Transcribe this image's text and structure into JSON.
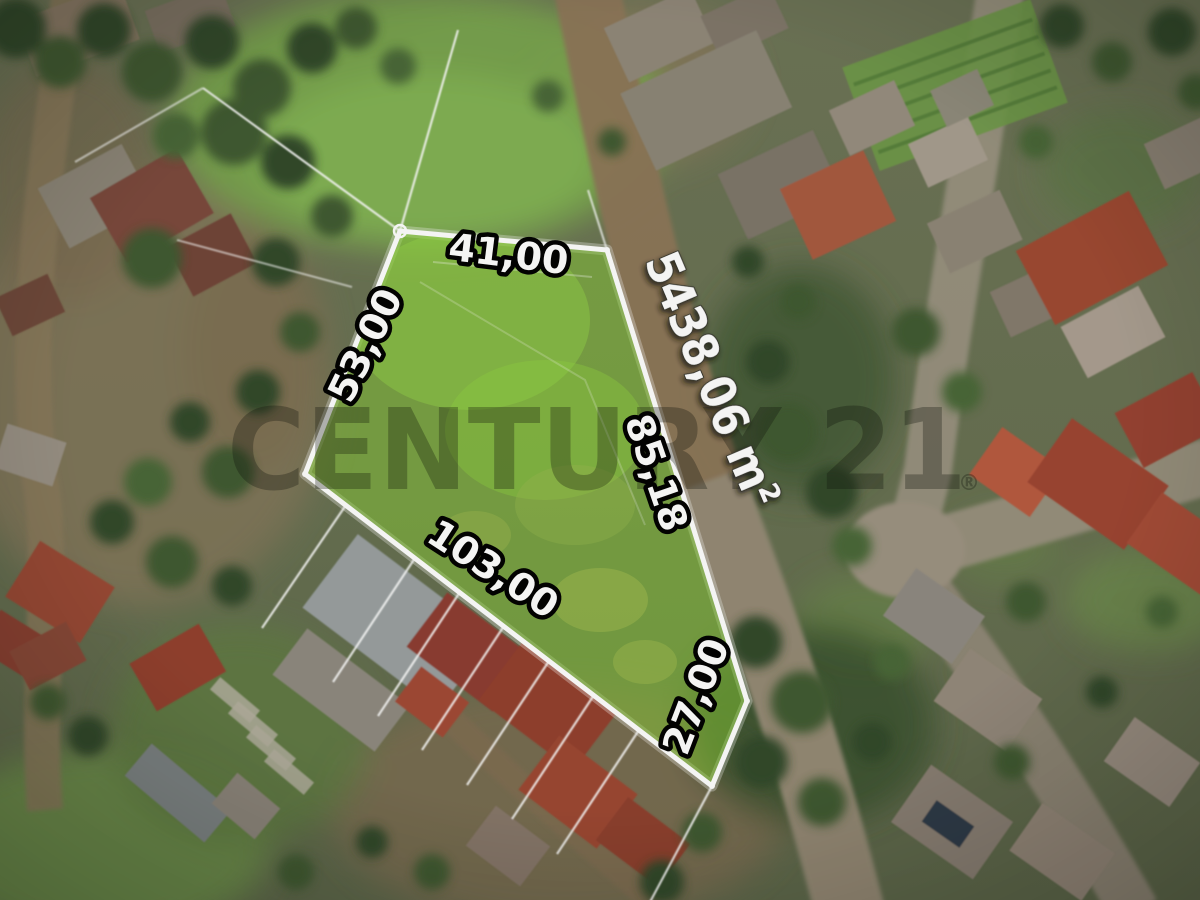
{
  "image": {
    "kind": "aerial drone photo of a land parcel for sale",
    "width_px": 1200,
    "height_px": 900
  },
  "watermark": {
    "brand": "CENTURY 21",
    "registered_mark": "®"
  },
  "parcel": {
    "area_label": "5438,06 m²",
    "measurements": [
      {
        "edge": "top",
        "value": "41,00"
      },
      {
        "edge": "left",
        "value": "53,00"
      },
      {
        "edge": "right",
        "value": "85,18"
      },
      {
        "edge": "bottom-left",
        "value": "103,00"
      },
      {
        "edge": "bottom-right",
        "value": "27,00"
      }
    ],
    "colors": {
      "highlight_fill": "#8ad136",
      "boundary": "#ffffff",
      "label_fill": "#ffffff",
      "label_outline": "#000000"
    }
  }
}
